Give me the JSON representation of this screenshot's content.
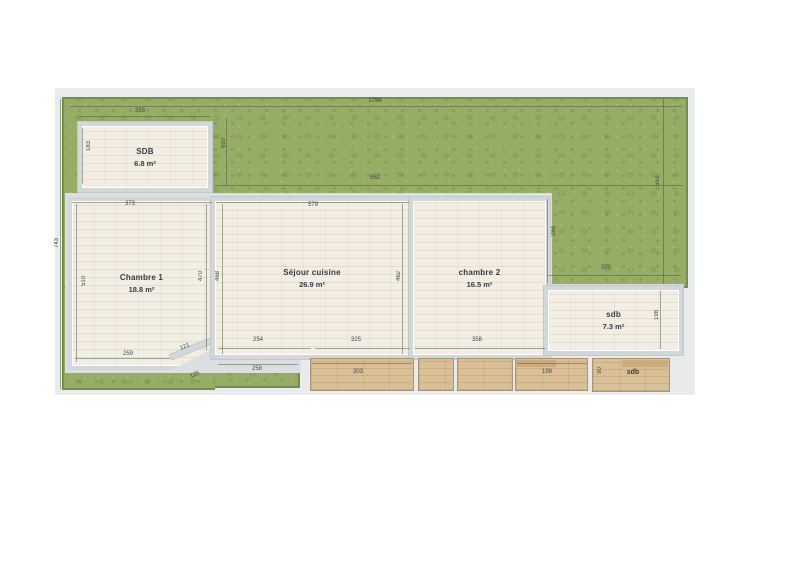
{
  "rooms": [
    {
      "name": "SDB",
      "area": "6.8 m²"
    },
    {
      "name": "Chambre 1",
      "area": "18.8 m²"
    },
    {
      "name": "Séjour cuisine",
      "area": "26.9 m²"
    },
    {
      "name": "chambre 2",
      "area": "16.5 m²"
    },
    {
      "name": "sdb",
      "area": "7.3 m²"
    }
  ],
  "deck": {
    "label": "sdb"
  },
  "dims": {
    "terrain_top": "1796",
    "sdb_top": "393",
    "sdb_left": "183",
    "garden_v_left": "693",
    "garden_mid": "952",
    "terrain_left": "743",
    "chambre1_top": "373",
    "sejour_top": "579",
    "terrain_right": "553",
    "garden_right_v": "284",
    "garden_right_h": "370",
    "chambre1_left": "510",
    "chambre1_right": "470",
    "sejour_left": "468",
    "sejour_right": "462",
    "sdb2_right": "198",
    "chambre1_bottom": "259",
    "chambre1_diag": "121",
    "sejour_bottom_l": "254",
    "sejour_bottom_r": "325",
    "chambre2_bottom": "358",
    "terrace_diag": "125",
    "terrace_green": "258",
    "deck_303": "303",
    "deck_198": "198",
    "deck_sdb_v": "90"
  },
  "colors": {
    "grass": "#95ad65",
    "grass_edge": "#73904b",
    "floor": "#f2eee3",
    "wall": "#d2d7d9",
    "wood": "#d9c097",
    "dim_text": "#474747"
  }
}
